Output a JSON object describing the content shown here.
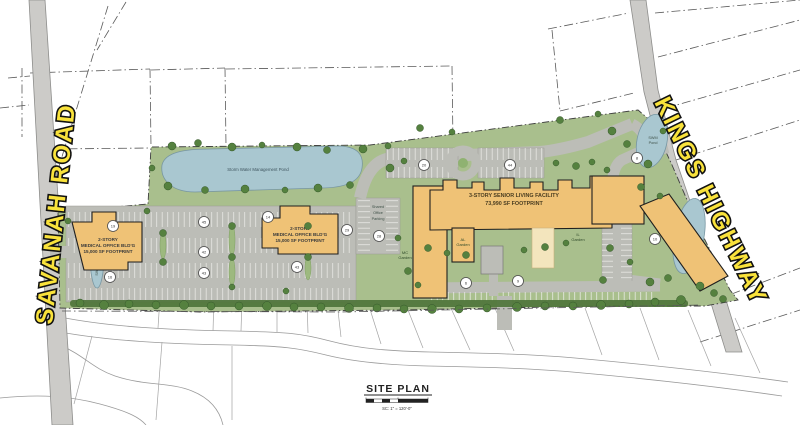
{
  "colors": {
    "site_green": "#a9bf8d",
    "tree_green": "#55813f",
    "pond_blue": "#a9c7d0",
    "parking_gray": "#bcbdb7",
    "road_gray": "#cccbc8",
    "building_tan": "#efc276",
    "courtyard_tan": "#f3e5bd",
    "label_yellow": "#f9e23b"
  },
  "roads": {
    "west_road": "SAVANAH ROAD",
    "east_road": "KINGS HIGHWAY"
  },
  "water": {
    "main_pond": "Storm Water Management Pond",
    "west_pond": "SWM Pond",
    "northeast_pond_line1": "SWM",
    "northeast_pond_line2": "Pond",
    "southeast_pond_line1": "SWM",
    "southeast_pond_line2": "Pond"
  },
  "buildings": {
    "west_medical": {
      "lines": [
        "2-STORY",
        "MEDICAL OFFICE BLD'G",
        "15,000 SF FOOTPRINT"
      ]
    },
    "east_medical": {
      "lines": [
        "2-STORY",
        "MEDICAL OFFICE BLD'G",
        "15,000 SF FOOTPRINT"
      ]
    },
    "senior_living": {
      "lines": [
        "3-STORY SENIOR LIVING FACILITY",
        "73,990 SF FOOTPRINT"
      ]
    }
  },
  "site_labels": {
    "shared_parking": [
      "Shared",
      "Office",
      "Parking"
    ],
    "mc_garden": [
      "MC",
      "Garden"
    ],
    "al_garden": [
      "AL",
      "Garden"
    ],
    "il_garden": [
      "IL",
      "Garden"
    ]
  },
  "parking_counts": [
    "19",
    "45",
    "42",
    "43",
    "16",
    "14",
    "29",
    "28",
    "43",
    "20",
    "44",
    "8",
    "10",
    "6",
    "9"
  ],
  "title_block": {
    "title": "SITE PLAN",
    "scale_note": "SC: 1\" = 120'-0\""
  }
}
